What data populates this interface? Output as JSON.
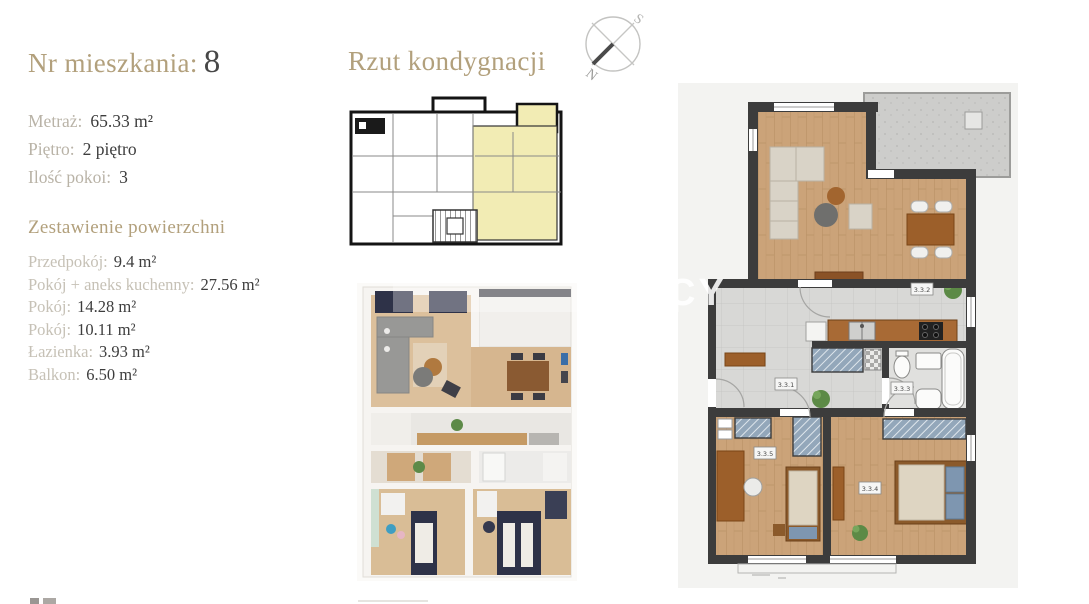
{
  "apartment": {
    "number_label": "Nr mieszkania:",
    "number": "8",
    "details": [
      {
        "label": "Metraż:",
        "value": "65.33 m²"
      },
      {
        "label": "Piętro:",
        "value": "2 piętro"
      },
      {
        "label": "Ilość pokoi:",
        "value": "3"
      }
    ],
    "areas_heading": "Zestawienie powierzchni",
    "areas": [
      {
        "label": "Przedpokój:",
        "value": "9.4 m²"
      },
      {
        "label": "Pokój + aneks kuchenny:",
        "value": "27.56 m²"
      },
      {
        "label": "Pokój:",
        "value": "14.28 m²"
      },
      {
        "label": "Pokój:",
        "value": "10.11 m²"
      },
      {
        "label": "Łazienka:",
        "value": "3.93 m²"
      },
      {
        "label": "Balkon:",
        "value": "6.50 m²"
      }
    ]
  },
  "floor_section": {
    "heading": "Rzut kondygnacji",
    "compass": {
      "north": "N",
      "south": "S"
    }
  },
  "plan": {
    "room_labels": [
      "3.3.1",
      "3.3.2",
      "3.3.3",
      "3.3.4",
      "3.3.5"
    ]
  },
  "watermark": {
    "fragment": "CY"
  },
  "colors": {
    "accent_tan": "#b2a07c",
    "label_gray": "#b9b3a7",
    "value_dark": "#3d3d3d",
    "highlight_yellow": "#f2ecb4",
    "wall_dark": "#3c3c3c",
    "wood_floor": "#cba379",
    "tile_gray": "#d8d8d6",
    "furniture_brown": "#9c5f2a",
    "textile_blue": "#7e96b0",
    "render_navy": "#2e3248"
  }
}
